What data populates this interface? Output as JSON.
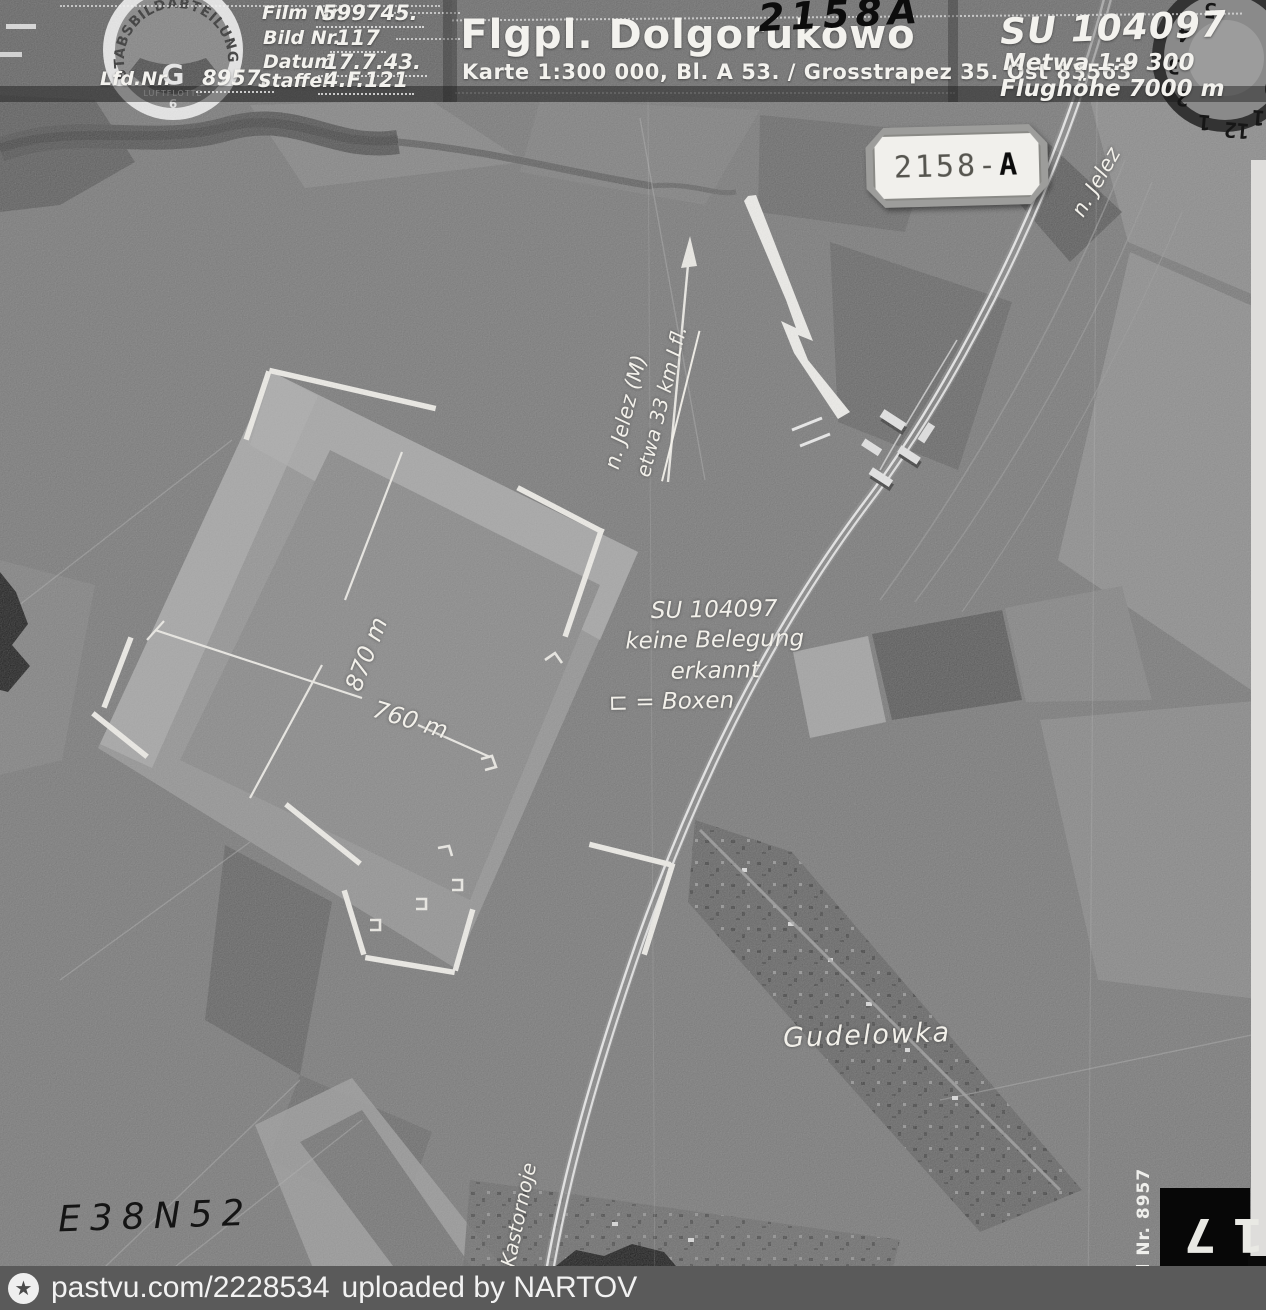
{
  "header": {
    "emblem": {
      "arc_text": "STABSBILDABTEILUNG",
      "center_letter": "G",
      "bottom_text": "LUFTFLOTTE",
      "bottom_number": "6"
    },
    "form": {
      "film_label": "Film Nr.",
      "film_value": "599745.",
      "bild_label": "Bild Nr.",
      "bild_value": "117",
      "datum_label": "Datum",
      "datum_value": "17.7.43.",
      "lfd_label": "Lfd.Nr.",
      "lfd_value": "8957.",
      "staffel_label": "Staffel",
      "staffel_value": "4.F.121"
    },
    "title": "Flgpl. Dolgorukowo",
    "subtitle": "Karte 1:300 000, Bl. A 53. / Grosstrapez 35. Ost 83563",
    "handwritten_number": "2158A",
    "photo_id": "SU 104097",
    "scale": "Metwa 1:9 300",
    "altitude": "Flughöhe 7000 m",
    "dial_numbers": [
      "5",
      "4",
      "3",
      "2",
      "1",
      "12",
      "11",
      "10"
    ]
  },
  "stamp": {
    "number": "2158-",
    "suffix": "A"
  },
  "annotations": {
    "arrow_label_line1": "n. Jelez (M)",
    "arrow_label_line2": "etwa 33 km Lfl.",
    "note_line1": "SU 104097",
    "note_line2": "keine Belegung",
    "note_line3": "erkannt",
    "note_line4": "⊏ = Boxen",
    "measure_ns": "870 m",
    "measure_ew": "760 m",
    "village": "Gudelowka",
    "rail_dir_north": "n. Jelez",
    "rail_dir_south": "v. Kastornoje",
    "grid_ref": "E38N52",
    "margin_number": "Lfd Nr. 8957",
    "frame_number": "117"
  },
  "footer": {
    "site": "pastvu.com/2228534",
    "uploaded": "uploaded by NARTOV"
  },
  "colors": {
    "photo_base": "#6f6f6f",
    "annotation_white": "#f2f0ea",
    "ink_black": "#101010",
    "footer_bar": "#5a5a5a"
  }
}
